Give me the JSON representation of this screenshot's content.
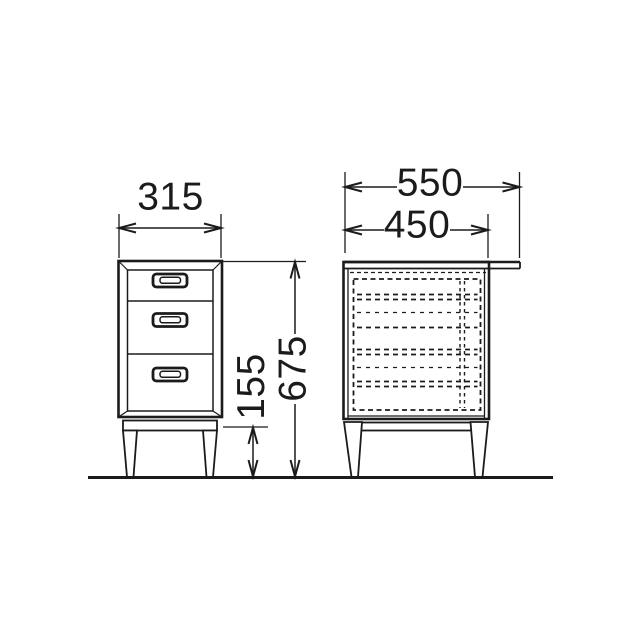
{
  "diagram": {
    "subject": "three-drawer side cabinet, front and side elevation drawing",
    "background_color": "#ffffff",
    "line_color": "#1b1b1b",
    "dimensions": {
      "front_width": "315",
      "overall_depth": "550",
      "body_depth": "450",
      "leg_height": "155",
      "overall_height": "675"
    }
  }
}
